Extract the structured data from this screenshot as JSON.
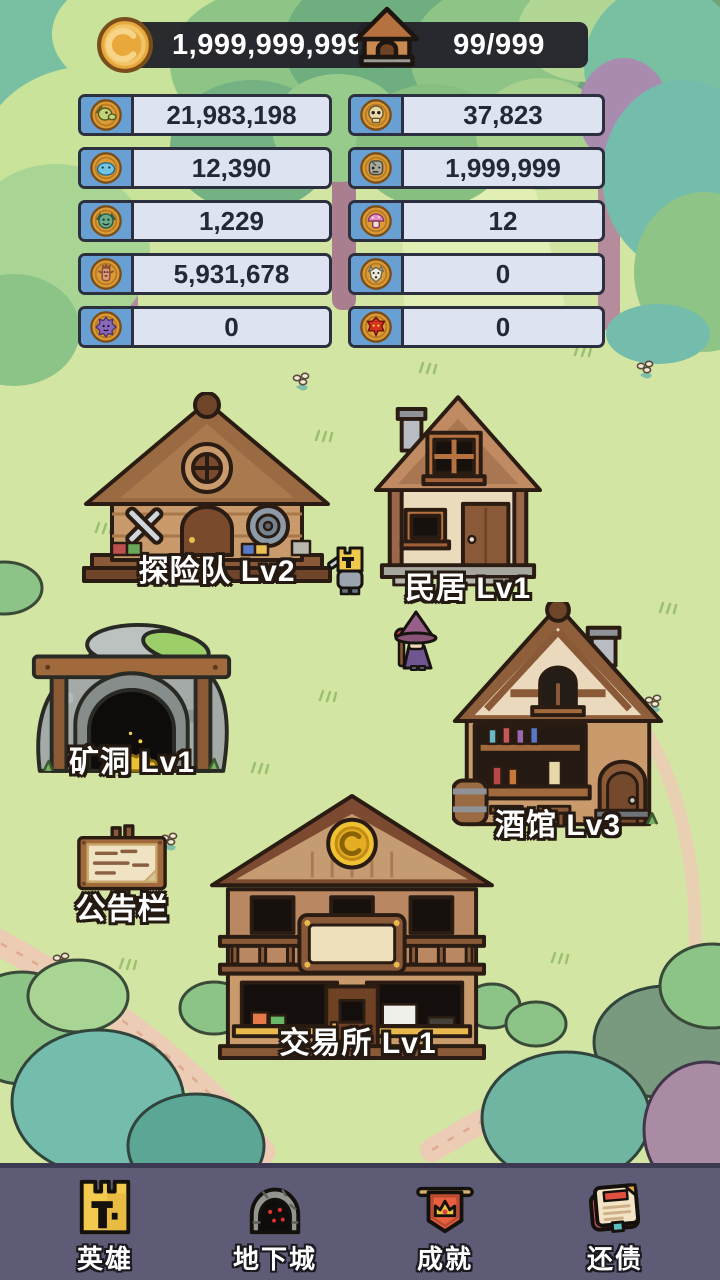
{
  "colors": {
    "grass": "#d3e5a3",
    "path": "#ecccb5",
    "navbar": "#5d5b75",
    "pill_bg": "#222129",
    "bar_bg": "#dde3f0",
    "bar_border": "#2c2f3e",
    "bar_icon_bg": "#68a0d4",
    "coin_gold": "#f0c233"
  },
  "header": {
    "coins": "1,999,999,999",
    "capacity": "99/999"
  },
  "resources": {
    "left": [
      {
        "name": "goblin",
        "value": "21,983,198"
      },
      {
        "name": "slime",
        "value": "12,390"
      },
      {
        "name": "imp",
        "value": "1,229"
      },
      {
        "name": "treant",
        "value": "5,931,678"
      },
      {
        "name": "purple-fish",
        "value": "0"
      }
    ],
    "right": [
      {
        "name": "skull",
        "value": "37,823"
      },
      {
        "name": "zombie",
        "value": "1,999,999"
      },
      {
        "name": "mushroom",
        "value": "12"
      },
      {
        "name": "wolf",
        "value": "0"
      },
      {
        "name": "demon",
        "value": "0"
      }
    ]
  },
  "buildings": [
    {
      "id": "explorer-camp",
      "label": "探险队 Lv2"
    },
    {
      "id": "residence",
      "label": "民居 Lv1"
    },
    {
      "id": "mine",
      "label": "矿洞 Lv1"
    },
    {
      "id": "tavern",
      "label": "酒馆 Lv3"
    },
    {
      "id": "notice-board",
      "label": "公告栏"
    },
    {
      "id": "exchange",
      "label": "交易所 Lv1"
    }
  ],
  "nav": [
    {
      "id": "hero",
      "label": "英雄"
    },
    {
      "id": "dungeon",
      "label": "地下城"
    },
    {
      "id": "achievements",
      "label": "成就"
    },
    {
      "id": "repay-debt",
      "label": "还债"
    }
  ]
}
